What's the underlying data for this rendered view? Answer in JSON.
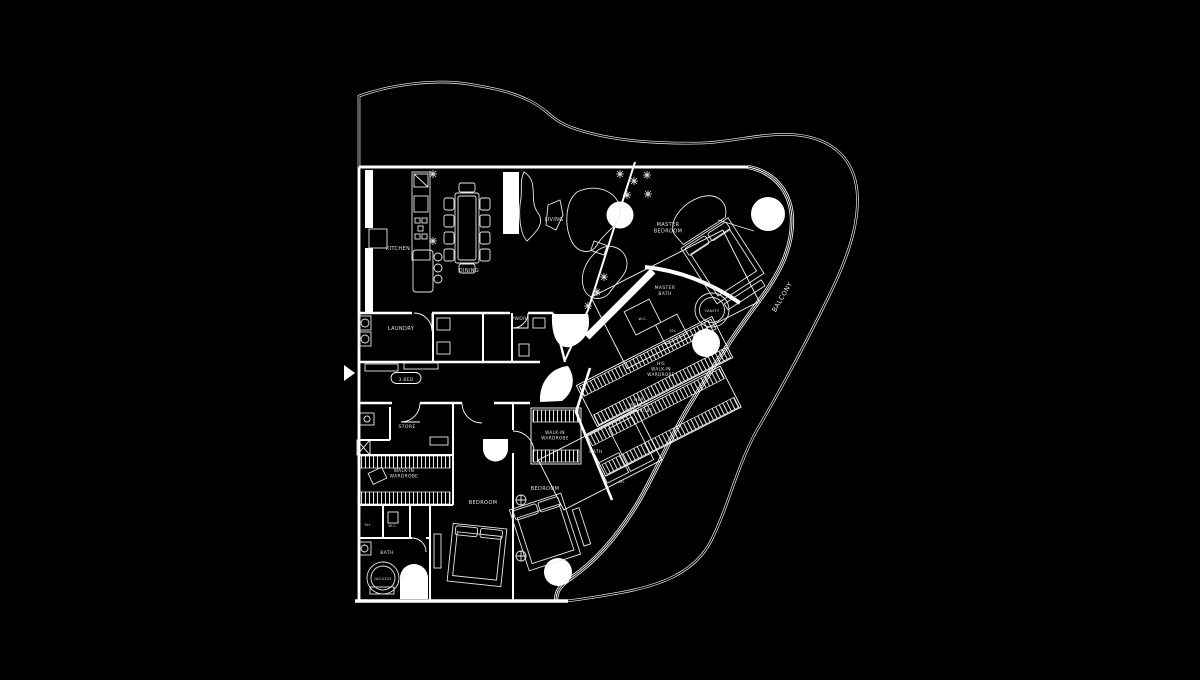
{
  "floor_plan": {
    "unit_tag": "3 BED",
    "colors": {
      "background": "#000000",
      "lines": "#ffffff",
      "text": "#e2e2e2"
    },
    "labels": [
      {
        "id": "kitchen",
        "lines": [
          "KITCHEN"
        ],
        "x": 398,
        "y": 250,
        "size": 5
      },
      {
        "id": "dining",
        "lines": [
          "DINING"
        ],
        "x": 469,
        "y": 272,
        "size": 5
      },
      {
        "id": "living",
        "lines": [
          "LIVING"
        ],
        "x": 554,
        "y": 221,
        "size": 5
      },
      {
        "id": "master-bedroom",
        "lines": [
          "MASTER",
          "BEDROOM"
        ],
        "x": 668,
        "y": 226,
        "size": 5
      },
      {
        "id": "master-bath",
        "lines": [
          "MASTER",
          "BATH"
        ],
        "x": 665,
        "y": 289,
        "size": 4.5
      },
      {
        "id": "vanity",
        "lines": [
          "VANITY"
        ],
        "x": 712,
        "y": 312,
        "size": 3.6
      },
      {
        "id": "wc-master",
        "lines": [
          "W.C."
        ],
        "x": 643,
        "y": 320,
        "size": 3.6
      },
      {
        "id": "sh-master",
        "lines": [
          "SH."
        ],
        "x": 673,
        "y": 332,
        "size": 3.6
      },
      {
        "id": "balcony",
        "lines": [
          "BALCONY"
        ],
        "x": 784,
        "y": 298,
        "size": 6.5,
        "rotate": -60
      },
      {
        "id": "laundry",
        "lines": [
          "LAUNDRY"
        ],
        "x": 401,
        "y": 330,
        "size": 5
      },
      {
        "id": "pwdr",
        "lines": [
          "PWDR"
        ],
        "x": 519,
        "y": 320,
        "size": 4.5
      },
      {
        "id": "unit-tag",
        "lines": [
          "3 BED"
        ],
        "x": 406,
        "y": 381,
        "size": 4.4
      },
      {
        "id": "store",
        "lines": [
          "STORE"
        ],
        "x": 407,
        "y": 428,
        "size": 4.6
      },
      {
        "id": "walkin-wardrobe-left",
        "lines": [
          "WALK-IN",
          "WARDROBE"
        ],
        "x": 404,
        "y": 472,
        "size": 4.4
      },
      {
        "id": "his-walkin-wardrobe",
        "lines": [
          "HIS",
          "WALK-IN",
          "WARDROBE"
        ],
        "x": 661,
        "y": 365,
        "size": 4.2
      },
      {
        "id": "her-walkin-wardrobe",
        "lines": [
          "HER",
          "WALK-IN",
          "WARDROBE"
        ],
        "x": 639,
        "y": 401,
        "size": 4.2
      },
      {
        "id": "walkin-wardrobe-bed2",
        "lines": [
          "WALK-IN",
          "WARDROBE"
        ],
        "x": 555,
        "y": 434,
        "size": 4.2
      },
      {
        "id": "bath-bed2",
        "lines": [
          "BATH"
        ],
        "x": 596,
        "y": 453,
        "size": 4.6
      },
      {
        "id": "sh-bed2",
        "lines": [
          "SH."
        ],
        "x": 622,
        "y": 483,
        "size": 3.6
      },
      {
        "id": "bedroom-center",
        "lines": [
          "BEDROOM"
        ],
        "x": 483,
        "y": 504,
        "size": 5
      },
      {
        "id": "bedroom-right",
        "lines": [
          "BEDROOM"
        ],
        "x": 545,
        "y": 490,
        "size": 5
      },
      {
        "id": "sh-left",
        "lines": [
          "SH."
        ],
        "x": 368,
        "y": 526,
        "size": 3.6
      },
      {
        "id": "wc-left",
        "lines": [
          "W.C."
        ],
        "x": 393,
        "y": 527,
        "size": 3.6
      },
      {
        "id": "bath-left",
        "lines": [
          "BATH"
        ],
        "x": 387,
        "y": 554,
        "size": 4.6
      },
      {
        "id": "jacuzzi",
        "lines": [
          "JACUZZI"
        ],
        "x": 383,
        "y": 580,
        "size": 3.6
      }
    ]
  }
}
